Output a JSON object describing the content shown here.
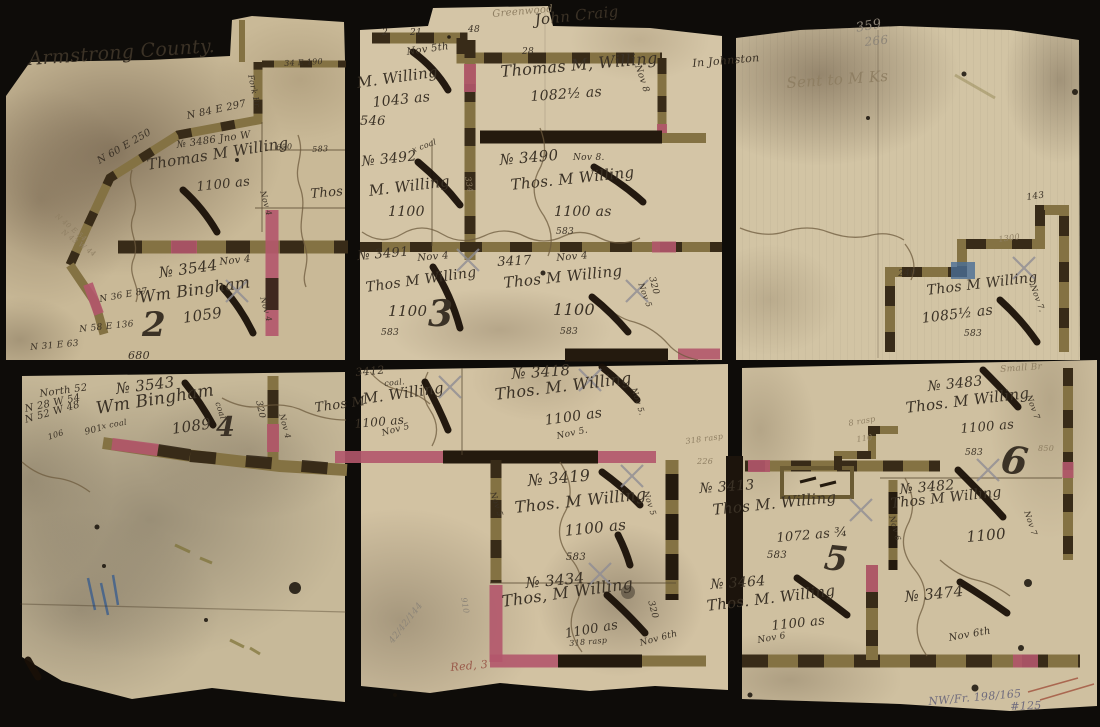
{
  "colors": {
    "ink": "#3b3226",
    "faded": "#8f7f63",
    "pencil": "#8d8578",
    "pencilBlue": "#6f6b7d",
    "red": "#9a5a4a"
  },
  "labels": [
    {
      "n": "county-title",
      "t": "Armstrong County.",
      "x": 28,
      "y": 50,
      "r": -4,
      "s": 19
    },
    {
      "n": "bearing-n84e297",
      "t": "N 84 E 297",
      "x": 186,
      "y": 112,
      "r": -12,
      "s": 10
    },
    {
      "n": "bearing-n60e250",
      "t": "N 60 E 250",
      "x": 96,
      "y": 158,
      "r": -30,
      "s": 10
    },
    {
      "n": "tract-3486-no",
      "t": "№ 3486 Jno W",
      "x": 176,
      "y": 141,
      "r": -8,
      "s": 10
    },
    {
      "n": "tract-3486-owner",
      "t": "Thomas M Willing",
      "x": 146,
      "y": 158,
      "r": -9,
      "s": 15
    },
    {
      "n": "tract-3486-acres",
      "t": "1100 as",
      "x": 196,
      "y": 181,
      "r": -6,
      "s": 13
    },
    {
      "n": "bearing-n40e54",
      "t": "N 40 E 54",
      "x": 58,
      "y": 213,
      "r": 40,
      "s": 7,
      "c": "faded"
    },
    {
      "n": "bearing-n43w44",
      "t": "N 43 W 44",
      "x": 64,
      "y": 229,
      "r": 36,
      "s": 7,
      "c": "faded"
    },
    {
      "n": "tract-3544-no",
      "t": "№ 3544",
      "x": 158,
      "y": 266,
      "r": -8,
      "s": 15
    },
    {
      "n": "tract-3544-date",
      "t": "Nov 4",
      "x": 219,
      "y": 258,
      "r": -6,
      "s": 10
    },
    {
      "n": "tract-3544-owner",
      "t": "Wm Bingham",
      "x": 138,
      "y": 290,
      "r": -8,
      "s": 16
    },
    {
      "n": "tract-3544-acres",
      "t": "1059",
      "x": 182,
      "y": 311,
      "r": -8,
      "s": 15
    },
    {
      "n": "sheet-number-2",
      "t": "2",
      "x": 142,
      "y": 308,
      "r": 0,
      "s": 34,
      "b": 1
    },
    {
      "n": "bearing-n36e87",
      "t": "N 36 E 87",
      "x": 99,
      "y": 296,
      "r": -10,
      "s": 9
    },
    {
      "n": "bearing-n58e136",
      "t": "N 58 E 136",
      "x": 79,
      "y": 326,
      "r": -6,
      "s": 9
    },
    {
      "n": "distance-680",
      "t": "680",
      "x": 128,
      "y": 350,
      "r": 0,
      "s": 11
    },
    {
      "n": "bearing-n31e63",
      "t": "N 31 E 63",
      "x": 30,
      "y": 344,
      "r": -5,
      "s": 9
    },
    {
      "n": "fork-br-note",
      "t": "Fork Br.",
      "x": 254,
      "y": 74,
      "r": 78,
      "s": 8
    },
    {
      "n": "bearing-34e190",
      "t": "34 E 190",
      "x": 284,
      "y": 60,
      "r": -3,
      "s": 8
    },
    {
      "n": "distance-650",
      "t": "650",
      "x": 276,
      "y": 144,
      "r": -3,
      "s": 8
    },
    {
      "n": "distance-583-tl",
      "t": "583",
      "x": 312,
      "y": 146,
      "r": -3,
      "s": 8
    },
    {
      "n": "partial-thos",
      "t": "Thos",
      "x": 310,
      "y": 188,
      "r": -5,
      "s": 13
    },
    {
      "n": "date-nov4-vert-a",
      "t": "Nov 4",
      "x": 266,
      "y": 190,
      "r": 75,
      "s": 8
    },
    {
      "n": "date-nov4-vert-b",
      "t": "Nov 4",
      "x": 266,
      "y": 296,
      "r": 75,
      "s": 8
    },
    {
      "n": "greenwood-note",
      "t": "Greenwood",
      "x": 492,
      "y": 10,
      "r": -5,
      "s": 10,
      "c": "faded"
    },
    {
      "n": "john-craig-name",
      "t": "John Craig",
      "x": 534,
      "y": 13,
      "r": -6,
      "s": 15
    },
    {
      "n": "tick-2",
      "t": "2",
      "x": 382,
      "y": 29,
      "r": 0,
      "s": 9
    },
    {
      "n": "tick-21",
      "t": "21",
      "x": 410,
      "y": 29,
      "r": 0,
      "s": 9
    },
    {
      "n": "tick-48",
      "t": "48",
      "x": 468,
      "y": 26,
      "r": 0,
      "s": 9
    },
    {
      "n": "tick-28",
      "t": "28",
      "x": 522,
      "y": 48,
      "r": 0,
      "s": 9
    },
    {
      "n": "date-nov5th",
      "t": "Nov 5th",
      "x": 406,
      "y": 48,
      "r": -8,
      "s": 10
    },
    {
      "n": "tract-1043-owner",
      "t": "M. Willing",
      "x": 356,
      "y": 76,
      "r": -8,
      "s": 15
    },
    {
      "n": "tract-1043-acres",
      "t": "1043 as",
      "x": 372,
      "y": 96,
      "r": -6,
      "s": 14
    },
    {
      "n": "distance-546",
      "t": "546",
      "x": 360,
      "y": 115,
      "r": 0,
      "s": 13
    },
    {
      "n": "tract-1082-owner",
      "t": "Thomas M, Willing",
      "x": 500,
      "y": 64,
      "r": -5,
      "s": 16
    },
    {
      "n": "tract-1082-acres",
      "t": "1082½ as",
      "x": 530,
      "y": 90,
      "r": -4,
      "s": 14
    },
    {
      "n": "date-nov8-vert",
      "t": "Nov 8",
      "x": 641,
      "y": 64,
      "r": 72,
      "s": 9
    },
    {
      "n": "tract-3492-no",
      "t": "№ 3492",
      "x": 361,
      "y": 155,
      "r": -6,
      "s": 14
    },
    {
      "n": "coal-note-3492",
      "t": "x coal",
      "x": 411,
      "y": 147,
      "r": -20,
      "s": 8
    },
    {
      "n": "tract-3492-owner",
      "t": "M. Willing",
      "x": 368,
      "y": 184,
      "r": -7,
      "s": 15
    },
    {
      "n": "tract-3492-acres",
      "t": "1100",
      "x": 388,
      "y": 205,
      "r": 0,
      "s": 14
    },
    {
      "n": "distance-334-vert",
      "t": "334",
      "x": 471,
      "y": 176,
      "r": 80,
      "s": 8,
      "c": "faded"
    },
    {
      "n": "tract-3490-no",
      "t": "№ 3490",
      "x": 499,
      "y": 153,
      "r": -5,
      "s": 15
    },
    {
      "n": "tract-3490-date",
      "t": "Nov 8.",
      "x": 573,
      "y": 154,
      "r": 0,
      "s": 9
    },
    {
      "n": "tract-3490-owner",
      "t": "Thos. M Willing",
      "x": 510,
      "y": 178,
      "r": -6,
      "s": 15
    },
    {
      "n": "tract-3490-acres",
      "t": "1100 as",
      "x": 554,
      "y": 205,
      "r": 0,
      "s": 14
    },
    {
      "n": "distance-583-3490",
      "t": "583",
      "x": 556,
      "y": 228,
      "r": 0,
      "s": 9
    },
    {
      "n": "tract-3491-no",
      "t": "№ 3491",
      "x": 357,
      "y": 250,
      "r": -5,
      "s": 13
    },
    {
      "n": "tract-3491-date",
      "t": "Nov 4",
      "x": 417,
      "y": 254,
      "r": -5,
      "s": 10
    },
    {
      "n": "tract-3491-owner",
      "t": "Thos M Willing",
      "x": 365,
      "y": 281,
      "r": -8,
      "s": 14
    },
    {
      "n": "tract-3491-acres",
      "t": "1100",
      "x": 388,
      "y": 304,
      "r": 0,
      "s": 15
    },
    {
      "n": "sheet-number-3",
      "t": "3",
      "x": 428,
      "y": 296,
      "r": 0,
      "s": 36,
      "b": 1
    },
    {
      "n": "distance-583-3491",
      "t": "583",
      "x": 381,
      "y": 329,
      "r": 0,
      "s": 9
    },
    {
      "n": "tract-3417-no",
      "t": "3417",
      "x": 497,
      "y": 256,
      "r": -3,
      "s": 13
    },
    {
      "n": "tract-3417-date",
      "t": "Nov 4",
      "x": 556,
      "y": 254,
      "r": -5,
      "s": 10
    },
    {
      "n": "tract-3417-owner",
      "t": "Thos M Willing",
      "x": 503,
      "y": 276,
      "r": -6,
      "s": 15
    },
    {
      "n": "tract-3417-acres",
      "t": "1100",
      "x": 553,
      "y": 302,
      "r": 0,
      "s": 16
    },
    {
      "n": "distance-583-3417",
      "t": "583",
      "x": 560,
      "y": 328,
      "r": 0,
      "s": 9
    },
    {
      "n": "distance-320-vert",
      "t": "320",
      "x": 655,
      "y": 276,
      "r": 75,
      "s": 9
    },
    {
      "n": "date-nov5-vert-tm",
      "t": "Nov 5",
      "x": 644,
      "y": 282,
      "r": 70,
      "s": 8
    },
    {
      "n": "pencil-359",
      "t": "359",
      "x": 855,
      "y": 22,
      "r": -10,
      "s": 13,
      "c": "pencil"
    },
    {
      "n": "pencil-266",
      "t": "266",
      "x": 864,
      "y": 36,
      "r": -6,
      "s": 12,
      "c": "pencil"
    },
    {
      "n": "in-johnston-note",
      "t": "In Johnston",
      "x": 692,
      "y": 58,
      "r": -5,
      "s": 11
    },
    {
      "n": "faint-note",
      "t": "Sent to M Ks",
      "x": 786,
      "y": 76,
      "r": -4,
      "s": 15,
      "c": "faded"
    },
    {
      "n": "distance-143",
      "t": "143",
      "x": 1026,
      "y": 194,
      "r": -8,
      "s": 9
    },
    {
      "n": "distance-1300",
      "t": "1300",
      "x": 998,
      "y": 236,
      "r": -8,
      "s": 8,
      "c": "faded"
    },
    {
      "n": "distance-240",
      "t": "240",
      "x": 898,
      "y": 270,
      "r": -3,
      "s": 9
    },
    {
      "n": "tract-1085-owner",
      "t": "Thos M Willing",
      "x": 926,
      "y": 284,
      "r": -7,
      "s": 14
    },
    {
      "n": "tract-1085-acres",
      "t": "1085½ as",
      "x": 921,
      "y": 312,
      "r": -7,
      "s": 14
    },
    {
      "n": "distance-583-tr",
      "t": "583",
      "x": 964,
      "y": 330,
      "r": 0,
      "s": 9
    },
    {
      "n": "date-nov7-vert-tr",
      "t": "Nov 7.",
      "x": 1036,
      "y": 284,
      "r": 70,
      "s": 8
    },
    {
      "n": "small-br-note",
      "t": "Small Br",
      "x": 1000,
      "y": 366,
      "r": -4,
      "s": 9,
      "c": "faded"
    },
    {
      "n": "tract-3543-no",
      "t": "№ 3543",
      "x": 115,
      "y": 382,
      "r": -7,
      "s": 15
    },
    {
      "n": "tract-3543-owner",
      "t": "Wm Bingham",
      "x": 95,
      "y": 401,
      "r": -9,
      "s": 17
    },
    {
      "n": "tract-3543-acres",
      "t": "1089",
      "x": 171,
      "y": 422,
      "r": -8,
      "s": 15
    },
    {
      "n": "sheet-number-4",
      "t": "4",
      "x": 216,
      "y": 414,
      "r": 0,
      "s": 27,
      "b": 1
    },
    {
      "n": "bearing-north52",
      "t": "North 52",
      "x": 39,
      "y": 390,
      "r": -8,
      "s": 10
    },
    {
      "n": "bearing-n28w54",
      "t": "N 28 W 54",
      "x": 24,
      "y": 405,
      "r": -12,
      "s": 10
    },
    {
      "n": "bearing-n52w48",
      "t": "N 52 W 48",
      "x": 24,
      "y": 416,
      "r": -16,
      "s": 10
    },
    {
      "n": "distance-901",
      "t": "901",
      "x": 84,
      "y": 429,
      "r": -15,
      "s": 9
    },
    {
      "n": "distance-106",
      "t": "106",
      "x": 47,
      "y": 434,
      "r": -18,
      "s": 8
    },
    {
      "n": "coal-note-3543",
      "t": "x coal",
      "x": 101,
      "y": 423,
      "r": -10,
      "s": 8
    },
    {
      "n": "coal-note-vert",
      "t": "coal",
      "x": 221,
      "y": 401,
      "r": 72,
      "s": 8
    },
    {
      "n": "distance-320-bl",
      "t": "320",
      "x": 262,
      "y": 400,
      "r": 78,
      "s": 9
    },
    {
      "n": "date-nov4-bl",
      "t": "Nov 4",
      "x": 285,
      "y": 413,
      "r": 75,
      "s": 8
    },
    {
      "n": "partial-thos-m",
      "t": "Thos M",
      "x": 314,
      "y": 402,
      "r": -8,
      "s": 13
    },
    {
      "n": "tract-3412-no",
      "t": "3412",
      "x": 355,
      "y": 367,
      "r": -5,
      "s": 11
    },
    {
      "n": "coal-note-3412",
      "t": "coal.",
      "x": 384,
      "y": 380,
      "r": -5,
      "s": 8
    },
    {
      "n": "tract-3412-owner",
      "t": "M. Willing",
      "x": 362,
      "y": 392,
      "r": -8,
      "s": 15
    },
    {
      "n": "tract-3412-acres",
      "t": "1100 as",
      "x": 354,
      "y": 418,
      "r": -5,
      "s": 12
    },
    {
      "n": "tract-3412-date",
      "t": "Nov 5",
      "x": 381,
      "y": 430,
      "r": -15,
      "s": 9
    },
    {
      "n": "tract-3418-no",
      "t": "№ 3418",
      "x": 511,
      "y": 367,
      "r": -4,
      "s": 15
    },
    {
      "n": "tract-3418-owner",
      "t": "Thos. M. Willing",
      "x": 494,
      "y": 387,
      "r": -7,
      "s": 16
    },
    {
      "n": "tract-3418-acres",
      "t": "1100 as",
      "x": 544,
      "y": 414,
      "r": -8,
      "s": 14
    },
    {
      "n": "tract-3418-date",
      "t": "Nov 5.",
      "x": 556,
      "y": 433,
      "r": -12,
      "s": 9
    },
    {
      "n": "date-nov5-vert-3418",
      "t": "Nov 5.",
      "x": 637,
      "y": 387,
      "r": 72,
      "s": 8
    },
    {
      "n": "distance-318-rasp",
      "t": "318 rasp",
      "x": 685,
      "y": 438,
      "r": -8,
      "s": 8,
      "c": "faded"
    },
    {
      "n": "distance-226",
      "t": "226",
      "x": 697,
      "y": 458,
      "r": 0,
      "s": 8,
      "c": "faded"
    },
    {
      "n": "tract-3419-no",
      "t": "№ 3419",
      "x": 527,
      "y": 473,
      "r": -5,
      "s": 16
    },
    {
      "n": "tract-3419-owner",
      "t": "Thos. M Willing",
      "x": 514,
      "y": 500,
      "r": -6,
      "s": 16
    },
    {
      "n": "tract-3419-acres",
      "t": "1100 as",
      "x": 564,
      "y": 524,
      "r": -6,
      "s": 15
    },
    {
      "n": "distance-583-3419",
      "t": "583",
      "x": 566,
      "y": 553,
      "r": 0,
      "s": 10
    },
    {
      "n": "date-nov5-vert-l",
      "t": "Nov 5",
      "x": 496,
      "y": 491,
      "r": 72,
      "s": 8
    },
    {
      "n": "date-nov5-vert-r",
      "t": "Nov 5",
      "x": 649,
      "y": 490,
      "r": 72,
      "s": 8
    },
    {
      "n": "tract-3434-no",
      "t": "№ 3434",
      "x": 525,
      "y": 576,
      "r": -5,
      "s": 15
    },
    {
      "n": "tract-3434-owner",
      "t": "Thos, M Willing",
      "x": 501,
      "y": 594,
      "r": -8,
      "s": 16
    },
    {
      "n": "tract-3434-acres",
      "t": "1100 as",
      "x": 564,
      "y": 628,
      "r": -10,
      "s": 13
    },
    {
      "n": "distance-318-rasp-b",
      "t": "318 rasp",
      "x": 569,
      "y": 640,
      "r": -5,
      "s": 8
    },
    {
      "n": "distance-320-3434",
      "t": "320",
      "x": 654,
      "y": 600,
      "r": 75,
      "s": 9
    },
    {
      "n": "date-nov6th-3434",
      "t": "Nov 6th",
      "x": 639,
      "y": 640,
      "r": -15,
      "s": 9
    },
    {
      "n": "distance-910-vert",
      "t": "910",
      "x": 467,
      "y": 597,
      "r": 80,
      "s": 8,
      "c": "pencil"
    },
    {
      "n": "red-3-note",
      "t": "Red, 3",
      "x": 450,
      "y": 662,
      "r": -5,
      "s": 11,
      "c": "red"
    },
    {
      "n": "pencil-fraction",
      "t": "42/42/144",
      "x": 388,
      "y": 640,
      "r": -52,
      "s": 9,
      "c": "pencil"
    },
    {
      "n": "distance-8-rasp",
      "t": "8 rasp",
      "x": 848,
      "y": 420,
      "r": -10,
      "s": 8,
      "c": "faded"
    },
    {
      "n": "distance-110",
      "t": "110",
      "x": 856,
      "y": 436,
      "r": -8,
      "s": 8,
      "c": "faded"
    },
    {
      "n": "tract-3413-no",
      "t": "№ 3413",
      "x": 699,
      "y": 482,
      "r": -4,
      "s": 14
    },
    {
      "n": "tract-3413-owner",
      "t": "Thos M. Willing",
      "x": 712,
      "y": 503,
      "r": -6,
      "s": 15
    },
    {
      "n": "tract-3413-acres",
      "t": "1072 as ¾",
      "x": 776,
      "y": 532,
      "r": -5,
      "s": 13
    },
    {
      "n": "distance-583-3413",
      "t": "583",
      "x": 767,
      "y": 551,
      "r": 0,
      "s": 10
    },
    {
      "n": "sheet-number-5",
      "t": "5",
      "x": 826,
      "y": 541,
      "r": 6,
      "s": 34,
      "b": 1
    },
    {
      "n": "tract-3464-no",
      "t": "№ 3464",
      "x": 710,
      "y": 578,
      "r": -4,
      "s": 14
    },
    {
      "n": "tract-3464-owner",
      "t": "Thos. M. Willing",
      "x": 706,
      "y": 599,
      "r": -7,
      "s": 15
    },
    {
      "n": "tract-3464-acres",
      "t": "1100 as",
      "x": 771,
      "y": 620,
      "r": -6,
      "s": 13
    },
    {
      "n": "tract-3464-date",
      "t": "Nov 6",
      "x": 757,
      "y": 637,
      "r": -10,
      "s": 9
    },
    {
      "n": "tract-3474-no",
      "t": "№ 3474",
      "x": 904,
      "y": 590,
      "r": -6,
      "s": 15
    },
    {
      "n": "tract-3474-date",
      "t": "Nov 6th",
      "x": 948,
      "y": 634,
      "r": -10,
      "s": 10
    },
    {
      "n": "tract-3483-no",
      "t": "№ 3483",
      "x": 927,
      "y": 380,
      "r": -6,
      "s": 14
    },
    {
      "n": "tract-3483-owner",
      "t": "Thos. M Willing",
      "x": 905,
      "y": 401,
      "r": -7,
      "s": 15
    },
    {
      "n": "tract-3483-acres",
      "t": "1100 as",
      "x": 960,
      "y": 423,
      "r": -5,
      "s": 13
    },
    {
      "n": "distance-583-3483",
      "t": "583",
      "x": 965,
      "y": 449,
      "r": 0,
      "s": 9
    },
    {
      "n": "sheet-number-6",
      "t": "6",
      "x": 1004,
      "y": 440,
      "r": 8,
      "s": 38,
      "b": 1
    },
    {
      "n": "date-nov7-3483",
      "t": "Nov 7",
      "x": 1032,
      "y": 394,
      "r": 70,
      "s": 8
    },
    {
      "n": "tract-3482-no",
      "t": "№ 3482",
      "x": 899,
      "y": 483,
      "r": -5,
      "s": 14
    },
    {
      "n": "tract-3482-owner",
      "t": "Thos M Willing",
      "x": 890,
      "y": 497,
      "r": -6,
      "s": 14
    },
    {
      "n": "tract-3482-acres",
      "t": "1100",
      "x": 966,
      "y": 530,
      "r": -5,
      "s": 15
    },
    {
      "n": "date-nov6-vert-br",
      "t": "Nov 6",
      "x": 895,
      "y": 515,
      "r": 75,
      "s": 8
    },
    {
      "n": "date-nov7-vert-br",
      "t": "Nov 7",
      "x": 1030,
      "y": 510,
      "r": 72,
      "s": 8
    },
    {
      "n": "distance-850",
      "t": "850",
      "x": 1038,
      "y": 445,
      "r": 0,
      "s": 8,
      "c": "faded"
    },
    {
      "n": "archive-note",
      "t": "NW/Fr. 198/165",
      "x": 928,
      "y": 696,
      "r": -5,
      "s": 11,
      "c": "pencilBlue"
    },
    {
      "n": "price-note",
      "t": "#125",
      "x": 1010,
      "y": 701,
      "r": -2,
      "s": 11,
      "c": "pencilBlue"
    }
  ]
}
